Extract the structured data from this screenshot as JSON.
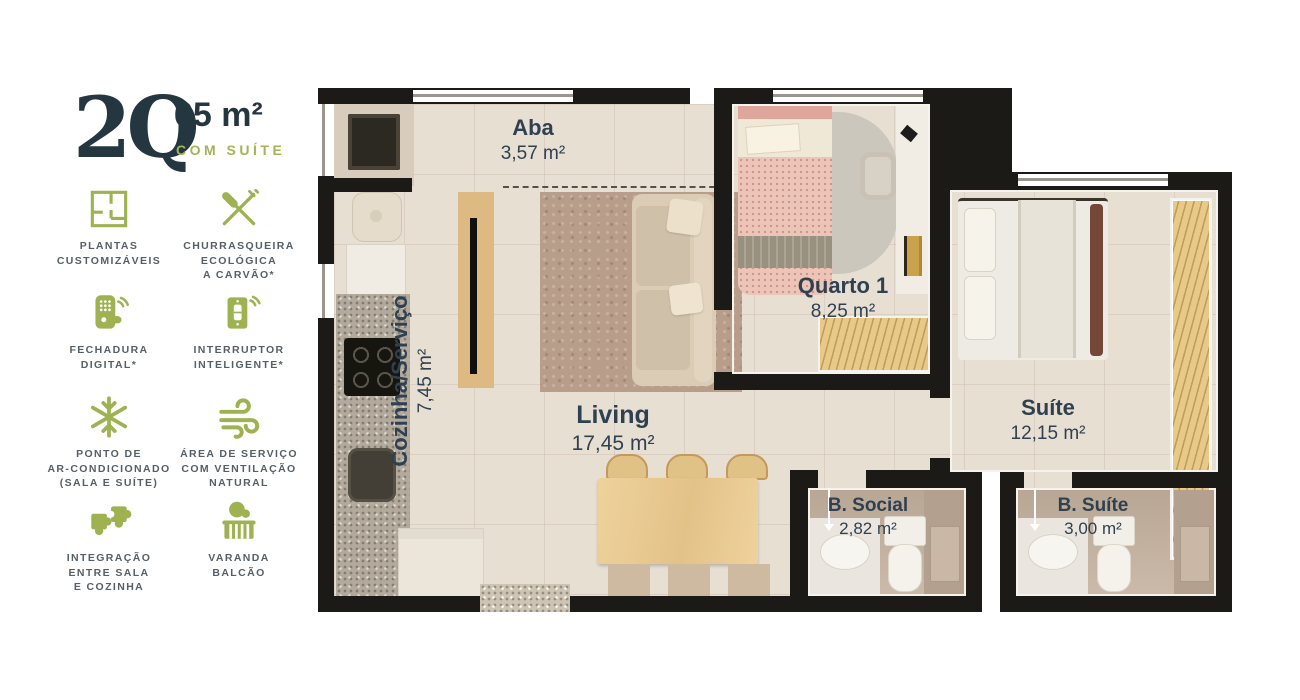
{
  "header": {
    "bedrooms": "2Q",
    "area": "65 m²",
    "tagline": "COM SUÍTE"
  },
  "features": [
    {
      "icon": "floorplan-icon",
      "label": "PLANTAS\nCUSTOMIZÁVEIS"
    },
    {
      "icon": "cutlery-icon",
      "label": "CHURRASQUEIRA\nECOLÓGICA\nA CARVÃO*"
    },
    {
      "icon": "smart-lock-icon",
      "label": "FECHADURA\nDIGITAL*"
    },
    {
      "icon": "smart-switch-icon",
      "label": "INTERRUPTOR\nINTELIGENTE*"
    },
    {
      "icon": "snowflake-icon",
      "label": "PONTO DE\nAR-CONDICIONADO\n(SALA E SUÍTE)"
    },
    {
      "icon": "wind-icon",
      "label": "ÁREA DE SERVIÇO\nCOM VENTILAÇÃO\nNATURAL"
    },
    {
      "icon": "puzzle-icon",
      "label": "INTEGRAÇÃO\nENTRE SALA\nE COZINHA"
    },
    {
      "icon": "balcony-icon",
      "label": "VARANDA\nBALCÃO"
    }
  ],
  "rooms": {
    "aba": {
      "name": "Aba",
      "area": "3,57 m²"
    },
    "cozinha": {
      "name": "Cozinha/Serviço",
      "area": "7,45 m²"
    },
    "living": {
      "name": "Living",
      "area": "17,45 m²"
    },
    "quarto1": {
      "name": "Quarto 1",
      "area": "8,25 m²"
    },
    "suite": {
      "name": "Suíte",
      "area": "12,15 m²"
    },
    "bsocial": {
      "name": "B. Social",
      "area": "2,82 m²"
    },
    "bsuite": {
      "name": "B. Suíte",
      "area": "3,00 m²"
    }
  },
  "colors": {
    "accent_green": "#9EB251",
    "heading_dark": "#243741",
    "label_text": "#565F67",
    "wall": "#1B1A17",
    "floor": "#E8DFD3",
    "room_label": "#2F4150"
  }
}
